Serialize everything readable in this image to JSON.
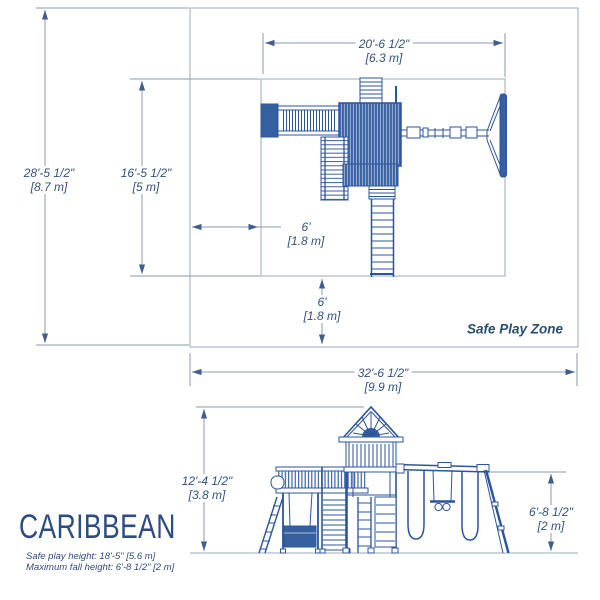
{
  "colors": {
    "structure_blue": "#2c549c",
    "structure_fill_blue": "#35609f",
    "dimension_line_gray": "#8a9ab0",
    "dimension_text_navy": "#33517e",
    "title_navy": "#2d4d80",
    "zone_text_navy": "#2a4e6e"
  },
  "plan_view": {
    "zone_label": "Safe Play Zone",
    "dimensions": {
      "overall_depth": {
        "imperial": "28'-5 1/2\"",
        "metric": "[8.7 m]"
      },
      "zone_depth": {
        "imperial": "16'-5 1/2\"",
        "metric": "[5 m]"
      },
      "zone_width": {
        "imperial": "20'-6 1/2\"",
        "metric": "[6.3 m]"
      },
      "side_clearance": {
        "imperial": "6'",
        "metric": "[1.8 m]"
      },
      "bottom_clearance": {
        "imperial": "6'",
        "metric": "[1.8 m]"
      },
      "overall_width": {
        "imperial": "32'-6 1/2\"",
        "metric": "[9.9 m]"
      }
    }
  },
  "elevation_view": {
    "dimensions": {
      "overall_height": {
        "imperial": "12'-4 1/2\"",
        "metric": "[3.8 m]"
      },
      "swing_beam_height": {
        "imperial": "6'-8 1/2\"",
        "metric": "[2 m]"
      }
    }
  },
  "title_block": {
    "product_name": "CARIBBEAN",
    "safe_play_height_note": "Safe play height: 18'-5\" [5.6 m]",
    "max_fall_height_note": "Maximum fall height: 6'-8 1/2\" [2 m]"
  }
}
